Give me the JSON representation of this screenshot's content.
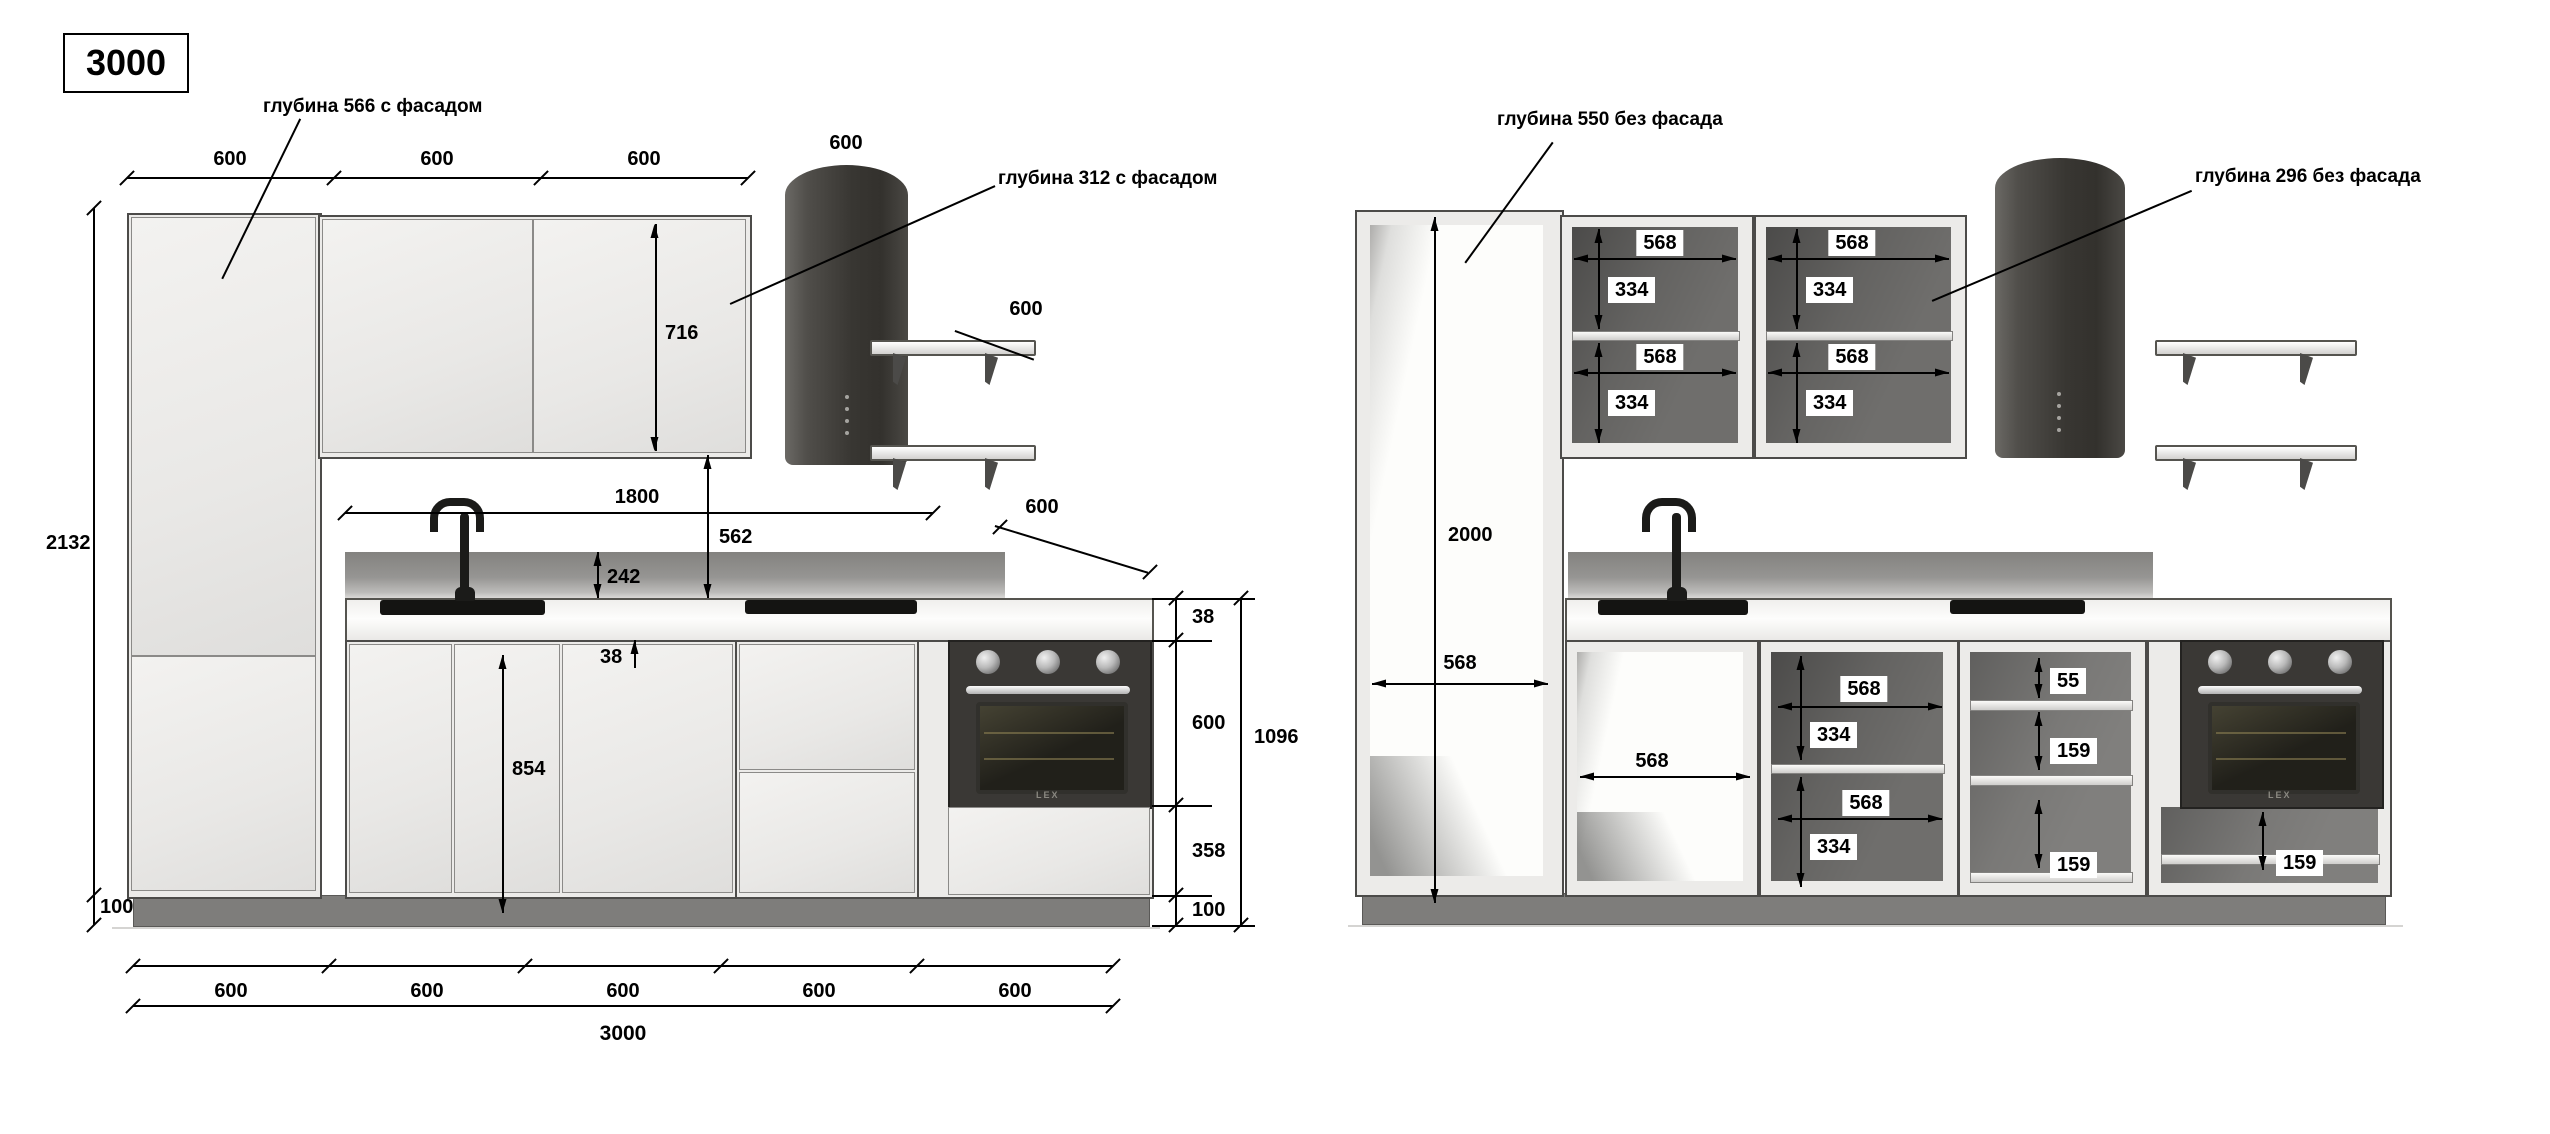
{
  "drawing": {
    "scheme_width_label": "3000",
    "left": {
      "depth_tall_note": "глубина 566 с фасадом",
      "depth_wall_note": "глубина 312 с фасадом",
      "top_widths": [
        "600",
        "600",
        "600"
      ],
      "hood_width": "600",
      "shelf_width": "600",
      "wall_cab_height": "716",
      "wall_run_width": "1800",
      "worktop_to_wall": "562",
      "apron_height": "242",
      "worktop_thickness_mid": "38",
      "base_cab_height": "854",
      "total_height": "2132",
      "plinth_height_left": "100",
      "worktop_depth": "600",
      "chain_worktop": "38",
      "chain_oven": "600",
      "chain_drawer": "358",
      "chain_plinth": "100",
      "chain_total": "1096",
      "bottom_widths": [
        "600",
        "600",
        "600",
        "600",
        "600"
      ],
      "total_width": "3000",
      "oven_brand": "LEX"
    },
    "right": {
      "depth_tall_note": "глубина 550 без фасада",
      "depth_wall_note": "глубина 296 без фасада",
      "tall_inner_height": "2000",
      "tall_inner_width": "568",
      "wall_cabs": [
        {
          "w": "568",
          "h": "334"
        },
        {
          "w": "568",
          "h": "334"
        },
        {
          "w": "568",
          "h": "334"
        },
        {
          "w": "568",
          "h": "334"
        }
      ],
      "sink_cab_width": "568",
      "mid_cab": {
        "w_top": "568",
        "h_top": "334",
        "w_bottom": "568",
        "h_bottom": "334"
      },
      "drawer_top": "55",
      "drawer_mid": "159",
      "drawer_bottom": "159",
      "oven_drawer": "159",
      "oven_brand": "LEX"
    },
    "colors": {
      "background": "#ffffff",
      "dimension": "#000000",
      "cabinet_light": "#ecebe9",
      "interior_dark": "#6f6e6c",
      "appliance_dark": "#3a3835",
      "backsplash": "#8f8e8c",
      "plinth": "#7e7d7b"
    }
  }
}
